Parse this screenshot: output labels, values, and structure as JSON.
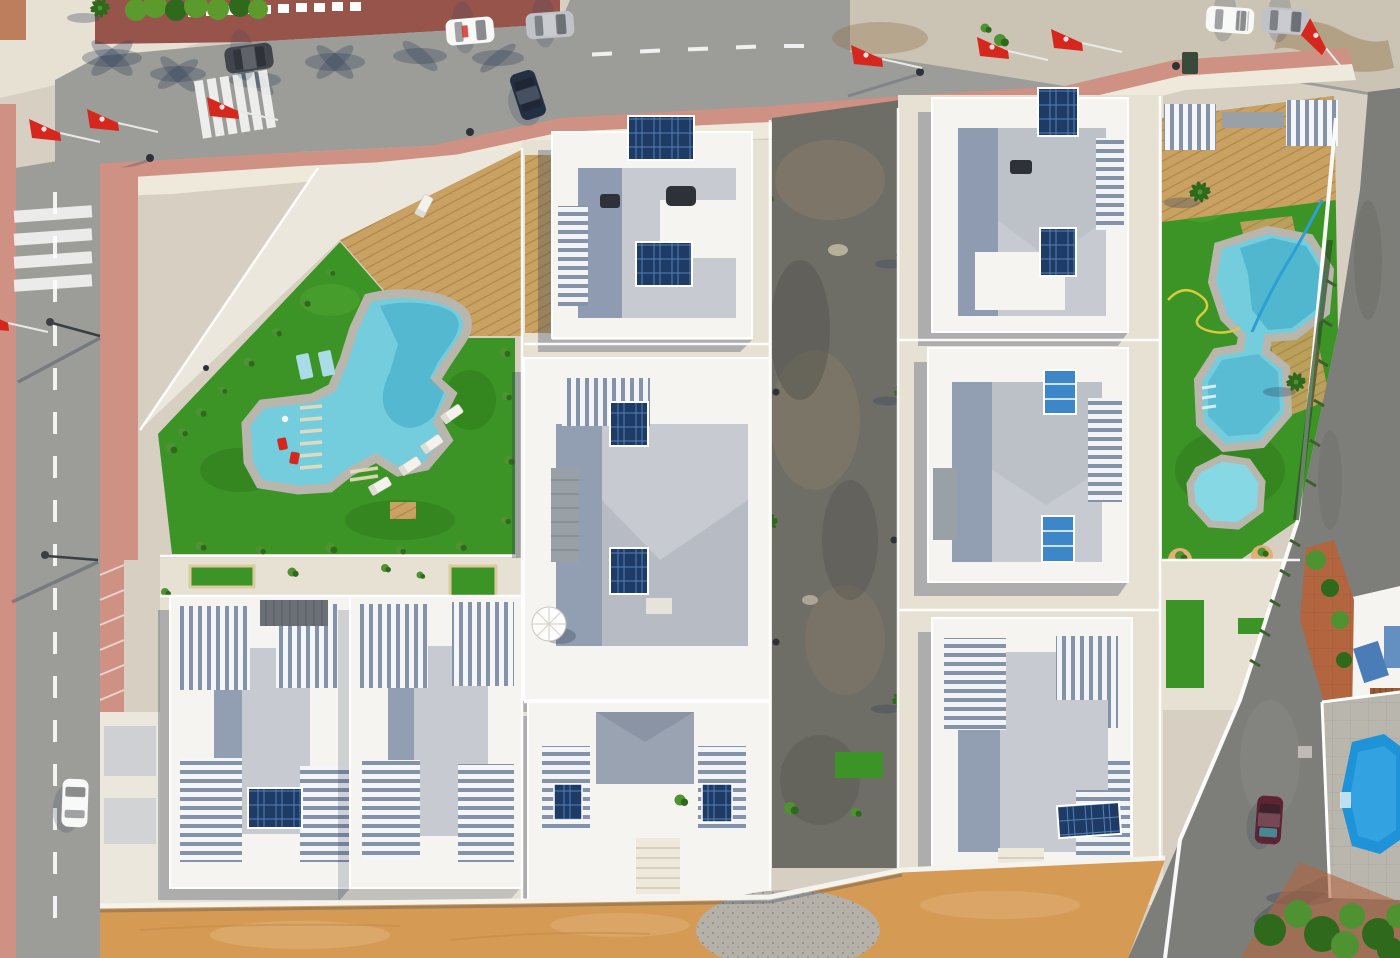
{
  "image": {
    "kind": "aerial-drone-photo",
    "description": "Top-down aerial view of a newly built white villa residential complex with two curved communal swimming pools on green artificial turf, an unpaved central lane, perimeter streets with parked cars, red promotional flags, palm-tree shadows and a sandy strip along the bottom.",
    "width_px": 1400,
    "height_px": 958
  },
  "palette": {
    "base": "#d6cfc2",
    "concrete": "#e7e1d4",
    "cream": "#efe9db",
    "pink": "#cf9183",
    "pinkDeep": "#c07f70",
    "brick": "#96544b",
    "hedge": "#5d9a2d",
    "asphalt": "#9c9c98",
    "asphaltLight": "#cbc4b4",
    "centerRoad": "#6e6d66",
    "rightRoad": "#7d7d79",
    "gravel": "#ece7dc",
    "sand": "#d59b55",
    "sandLight": "#e0b077",
    "wood": "#c9a162",
    "woodLine": "#ad8848",
    "turf": "#3c9326",
    "turfDark": "#2e7a19",
    "turfLight": "#4fa832",
    "pool": "#74cddd",
    "poolDeep": "#3ba8c6",
    "poolRing": "#b9b6ae",
    "poolBright": "#1f93d8",
    "spa": "#86d8e4",
    "villa": "#f5f4f1",
    "roofGray": "#c7cbd1",
    "roofSlate": "#8493aa",
    "roofDark": "#9aa3b2",
    "solar": "#1d3b64",
    "solarLite": "#3d86c8",
    "stone": "#99a0a6",
    "tan": "#dccb9f",
    "flag": "#d6271e",
    "shadow": "#32405a",
    "veg": "#4f9232",
    "vegDark": "#2f6a1c",
    "terracotta": "#b2653f",
    "dark": "#2e3238",
    "mud": "#8a7e69",
    "stain": "#8f6f46",
    "carDark": "#41454c",
    "carSilver": "#bfc2c6",
    "carWhite": "#f8f8f7",
    "carNavy": "#232f42",
    "carMaroon": "#5e2433",
    "glassTeal": "#47939e",
    "hoseYellow": "#d9ca3f",
    "hoseBlue": "#2e9fd4"
  },
  "scene": {
    "pools": [
      {
        "name": "left-curved-pool",
        "water": "light turquoise",
        "features": [
          "stepped shallow end",
          "two red chairs in water",
          "white starfish"
        ]
      },
      {
        "name": "right-lobed-pool",
        "water": "turquoise",
        "features": [
          "two connected lobes",
          "small octagonal spa",
          "blue and yellow hoses"
        ]
      },
      {
        "name": "corner-neighbor-pool",
        "water": "deep blue",
        "features": [
          "octagonal",
          "gray paved deck",
          "white fence"
        ]
      }
    ],
    "villas": {
      "count": 8,
      "style": "white flat-roof new builds with pergolas and rooftop solar panels"
    },
    "cars": [
      {
        "color": "dark gray",
        "location": "top road"
      },
      {
        "color": "white",
        "location": "top road"
      },
      {
        "color": "silver",
        "location": "top road"
      },
      {
        "color": "navy",
        "location": "top road"
      },
      {
        "color": "white van",
        "location": "top right parking"
      },
      {
        "color": "silver",
        "location": "top right parking"
      },
      {
        "color": "white",
        "location": "left road"
      },
      {
        "color": "maroon",
        "location": "bottom right road"
      }
    ],
    "flags": {
      "count": 8,
      "color": "red",
      "type": "promotional sale flags"
    },
    "ground": [
      "white gravel corner lot",
      "artificial turf",
      "wooden sun decks",
      "orange sand strip",
      "gravel circle",
      "unpaved central lane"
    ]
  }
}
